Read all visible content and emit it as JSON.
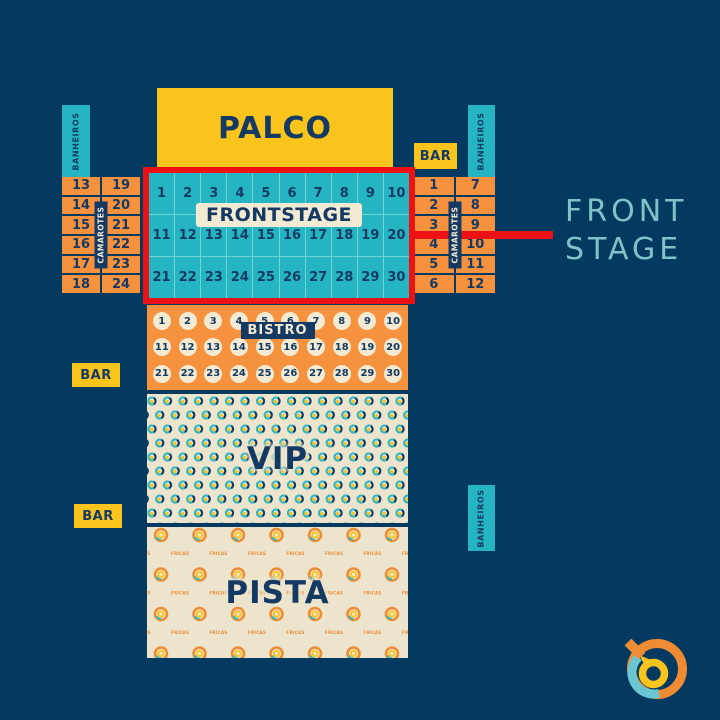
{
  "colors": {
    "background": "#043a60",
    "navy_text": "#143a64",
    "yellow": "#f9c41c",
    "teal": "#25b5c2",
    "teal_light": "#7fc3c9",
    "orange": "#f6913e",
    "cream": "#ece4cd",
    "cream_light": "#f2ead3",
    "red": "#ec1115"
  },
  "stage": {
    "label": "PALCO"
  },
  "frontstage": {
    "label": "FRONTSTAGE",
    "seats": [
      1,
      2,
      3,
      4,
      5,
      6,
      7,
      8,
      9,
      10,
      11,
      12,
      13,
      14,
      15,
      16,
      17,
      18,
      19,
      20,
      21,
      22,
      23,
      24,
      25,
      26,
      27,
      28,
      29,
      30
    ],
    "callout": {
      "line1": "FRONT",
      "line2": "STAGE"
    }
  },
  "camarotes": {
    "label": "CAMAROTES",
    "left": {
      "col1": [
        13,
        14,
        15,
        16,
        17,
        18
      ],
      "col2": [
        19,
        20,
        21,
        22,
        23,
        24
      ]
    },
    "right": {
      "col1": [
        1,
        2,
        3,
        4,
        5,
        6
      ],
      "col2": [
        7,
        8,
        9,
        10,
        11,
        12
      ]
    }
  },
  "bistro": {
    "label": "BISTRO",
    "seats": [
      1,
      2,
      3,
      4,
      5,
      6,
      7,
      8,
      9,
      10,
      11,
      12,
      13,
      14,
      15,
      16,
      17,
      18,
      19,
      20,
      21,
      22,
      23,
      24,
      25,
      26,
      27,
      28,
      29,
      30
    ]
  },
  "vip": {
    "label": "VIP"
  },
  "pista": {
    "label": "PISTA",
    "watermark": "FRICAS"
  },
  "bar": {
    "label": "BAR"
  },
  "banheiros": {
    "label": "BANHEIROS"
  },
  "icons": {
    "brand_logo": "circular-swirl-brand-logo"
  }
}
